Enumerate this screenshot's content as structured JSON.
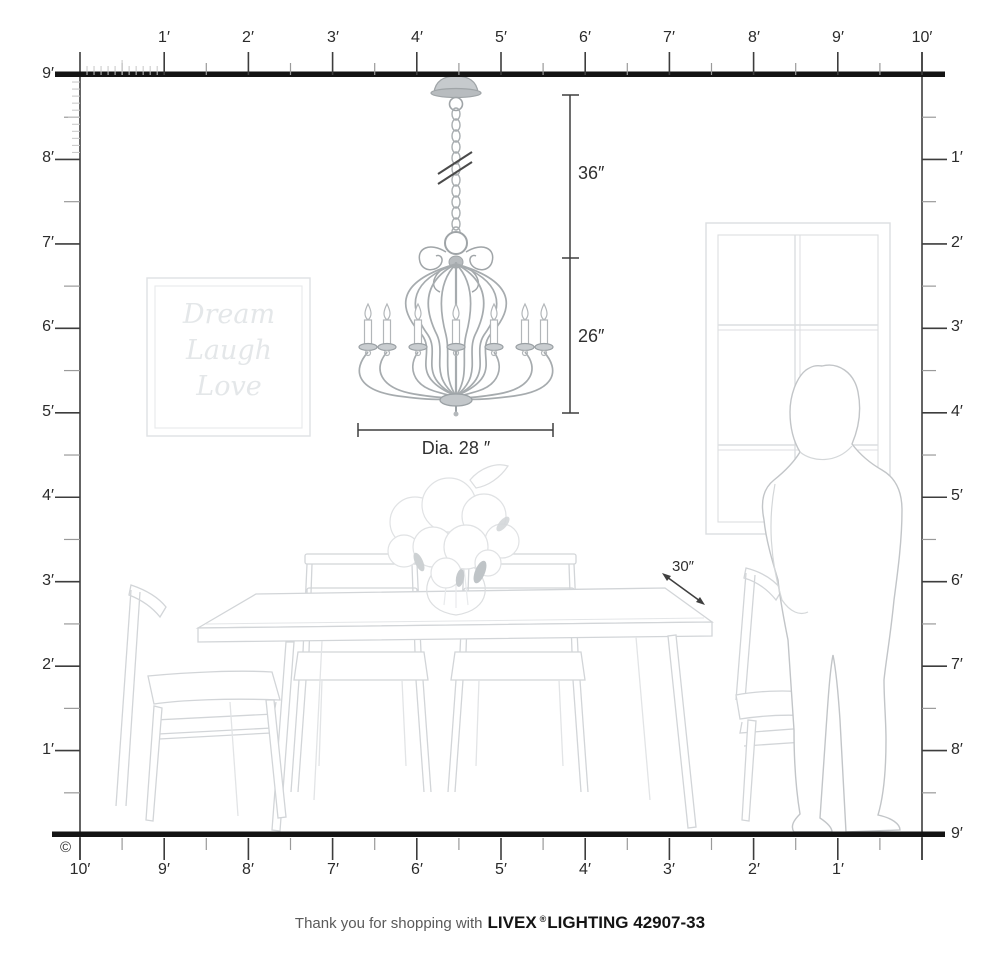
{
  "rulers": {
    "top": [
      "1′",
      "2′",
      "3′",
      "4′",
      "5′",
      "6′",
      "7′",
      "8′",
      "9′",
      "10′"
    ],
    "left": [
      "9′",
      "8′",
      "7′",
      "6′",
      "5′",
      "4′",
      "3′",
      "2′",
      "1′"
    ],
    "right": [
      "1′",
      "2′",
      "3′",
      "4′",
      "5′",
      "6′",
      "7′",
      "8′",
      "9′"
    ],
    "bottom": [
      "10′",
      "9′",
      "8′",
      "7′",
      "6′",
      "5′",
      "4′",
      "3′",
      "2′",
      "1′"
    ]
  },
  "dimensions": {
    "hang_height": "36″",
    "fixture_height": "26″",
    "diameter": "Dia. 28 ″",
    "table_depth": "30″"
  },
  "wall_art": {
    "line1": "Dream",
    "line2": "Laugh",
    "line3": "Love"
  },
  "footer": {
    "prefix": "Thank you for shopping with",
    "brand": "LIVEX",
    "registered": "®",
    "product": "LIGHTING 42907-33"
  },
  "copyright": "©",
  "colors": {
    "ink": "#141414",
    "dimension": "#3f3f3f",
    "sketch": "#d2d5d8",
    "metal": "#9fa4a7"
  }
}
